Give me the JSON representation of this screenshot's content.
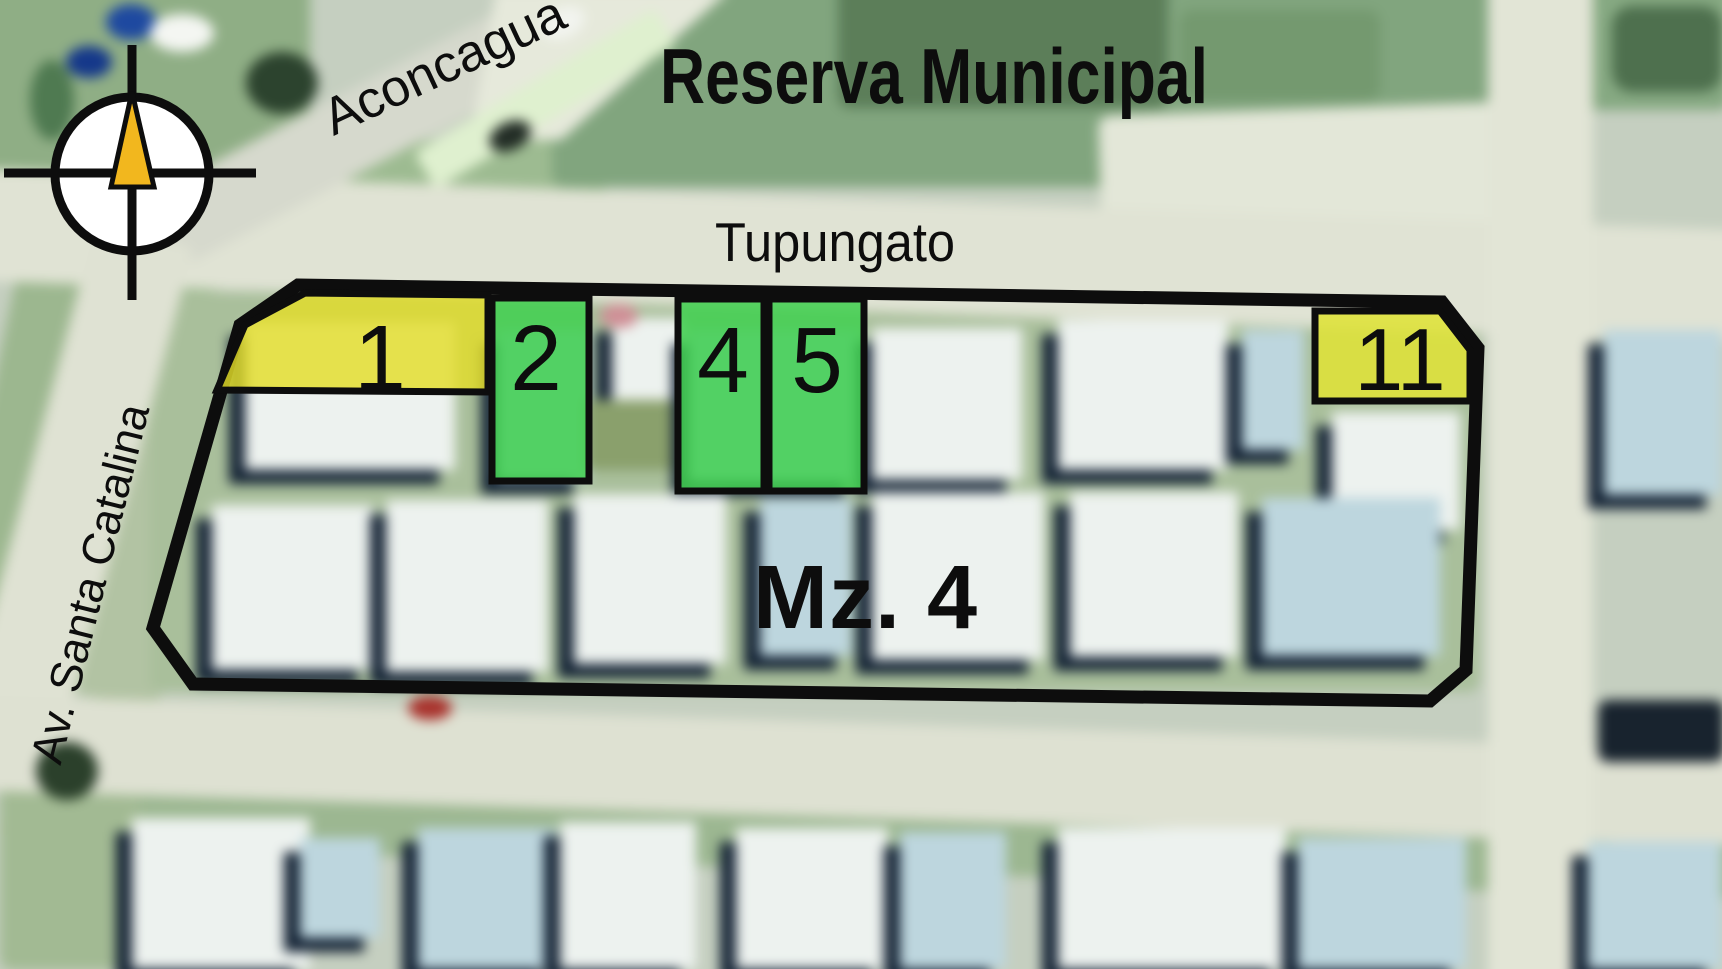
{
  "map": {
    "title": "Reserva Municipal",
    "block": {
      "label": "Mz. 4"
    },
    "streets": [
      {
        "id": "aconcagua",
        "name": "Aconcagua"
      },
      {
        "id": "tupungato",
        "name": "Tupungato"
      },
      {
        "id": "av-santa-catalina",
        "name": "Av. Santa Catalina"
      }
    ],
    "lots": [
      {
        "number": "1",
        "color": "#e3dd28",
        "shape": "corner-left-chamfer"
      },
      {
        "number": "2",
        "color": "#3fd04f",
        "shape": "rect"
      },
      {
        "number": "4",
        "color": "#3fd04f",
        "shape": "rect"
      },
      {
        "number": "5",
        "color": "#3fd04f",
        "shape": "rect"
      },
      {
        "number": "11",
        "color": "#dfe238",
        "shape": "corner-right-chamfer"
      }
    ],
    "colors": {
      "outline": "#0d0d0d",
      "lot_yellow": "#e3dd28",
      "lot_green": "#3fd04f",
      "compass_needle": "#f2b71e"
    },
    "compass": {
      "icon": "compass-north-icon"
    }
  }
}
